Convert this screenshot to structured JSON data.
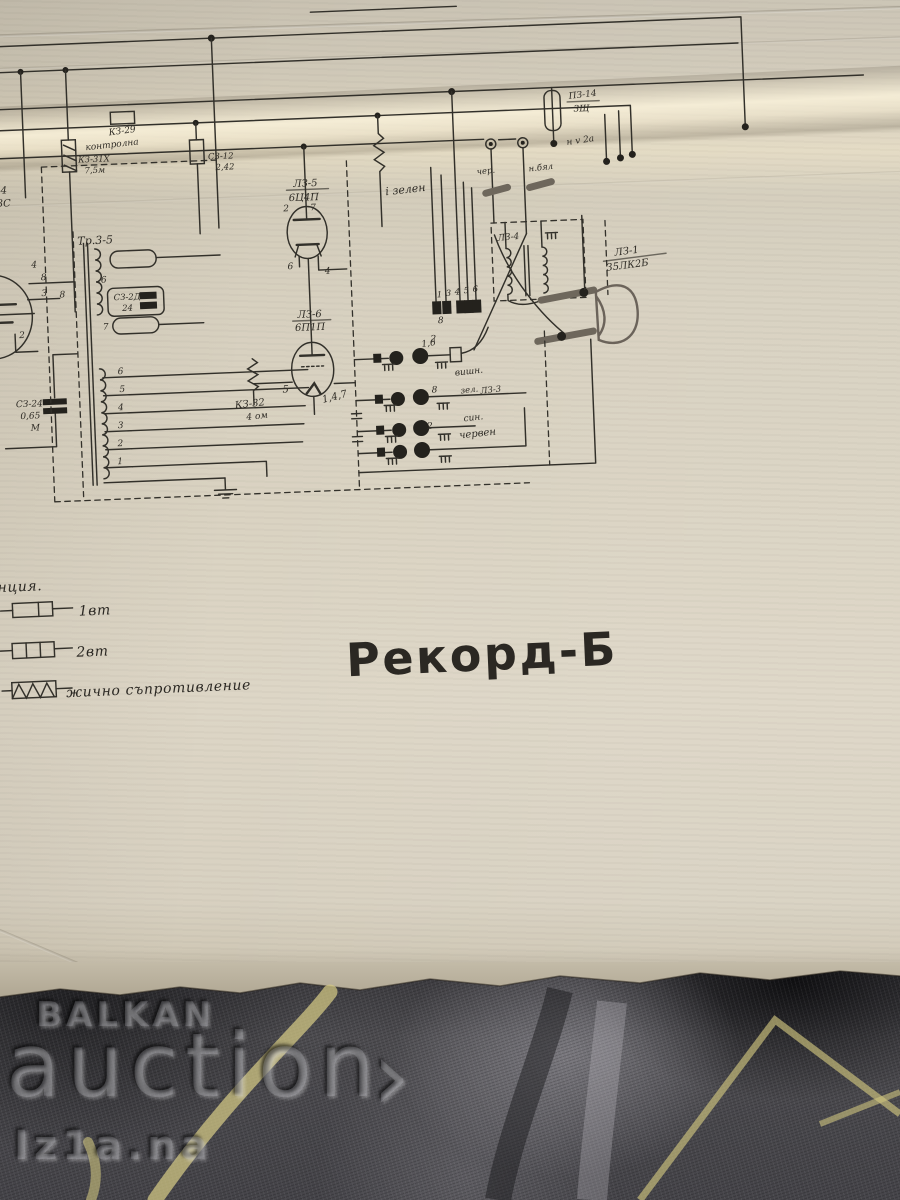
{
  "title": "Рекорд-Б",
  "legend": {
    "partial_word": "нция.",
    "items": [
      {
        "symbol": "resistor-1w",
        "label": "1вт"
      },
      {
        "symbol": "resistor-2w",
        "label": "2вт"
      },
      {
        "symbol": "wirewound-resistor",
        "label": "жично съпротивление"
      }
    ]
  },
  "watermark": {
    "brand_top": "BALKAN",
    "brand_main": "auction",
    "arrow": "›",
    "sub": "Iz1a.na"
  },
  "colors": {
    "paper": "#d8d1c0",
    "ink": "#32302a",
    "fabric": "#4a494d",
    "fabric_stripe": "#d5cb85"
  },
  "schematic": {
    "labels": {
      "transformer": "Тр.3-5",
      "left_tube_l1": "-4",
      "left_tube_l2": "3С",
      "cursive_top": "контролна",
      "r_top": "КЗ-29",
      "r31_1": "КЗ-31Х",
      "r31_2": "7,5м",
      "s12_1": "СЗ-12",
      "s12_2": "2,42",
      "tube1_name": "ЛЗ-5",
      "tube1_type": "6Ц4П",
      "wire_green": "і зелен",
      "fuse_1": "ПЗ-14",
      "fuse_2": "3Щ",
      "fuse_3": "н v 2а",
      "wire_black": "чер.",
      "wire_white": "н.бял",
      "out_tr": "ЛЗ-4",
      "speaker_1": "ЛЗ-1",
      "speaker_2": "35ЛК2Б",
      "tube2_name": "ЛЗ-6",
      "tube2_type": "6П1П",
      "tube2_pin5": "5",
      "tube2_pins": "1,4,7",
      "r32_1": "КЗ-32",
      "r32_2": "4 ом",
      "c24_1": "СЗ-24",
      "c24_2": "0,65",
      "c24_3": "М",
      "cap_int_1": "СЗ-2Д",
      "cap_int_2": "24",
      "t1p2": "2",
      "t1p7": "7",
      "t1p6": "6",
      "t1p4": "4",
      "tp6": "6",
      "tp7": "7",
      "tp8": "8",
      "tap6": "6",
      "tap5": "5",
      "tap4": "4",
      "tap3": "3",
      "tap2": "2",
      "tap1": "1",
      "lt4": "4",
      "lt8": "8",
      "lt3": "3",
      "lt2": "2",
      "sock_n1": "1",
      "sock_n2": "3",
      "sock_n3": "4",
      "sock_n4": "5",
      "sock_n5": "6",
      "sock_8": "8",
      "sock_2": "2",
      "row1_num": "1,6",
      "row1_color": "вишн.",
      "row2_num": "8",
      "row2_tag1": "зел.",
      "row2_tag2": "ЛЗ-3",
      "row2_color": "син.",
      "row3_num": "2",
      "row3_color": "червен"
    }
  }
}
